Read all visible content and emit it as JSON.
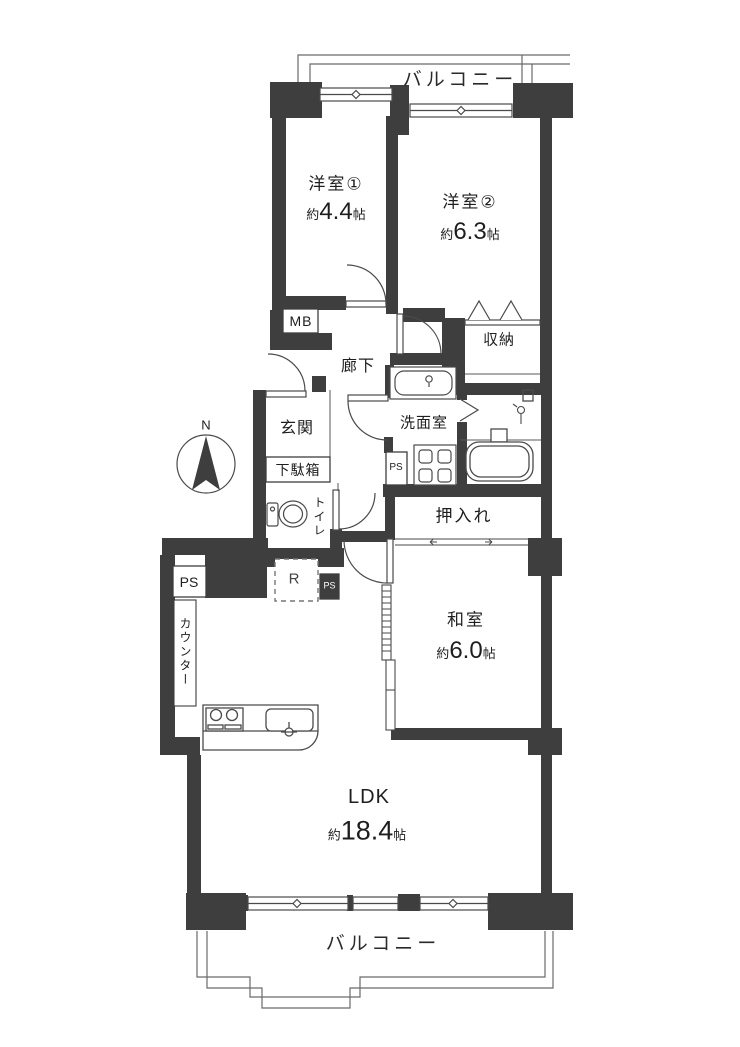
{
  "plan": {
    "compass": {
      "north_label": "N"
    },
    "balcony_top": {
      "label": "バルコニー"
    },
    "balcony_bottom": {
      "label": "バルコニー"
    },
    "rooms": {
      "yoshitsu1": {
        "name": "洋室①",
        "size_prefix": "約",
        "size_value": "4.4",
        "size_unit": "帖"
      },
      "yoshitsu2": {
        "name": "洋室②",
        "size_prefix": "約",
        "size_value": "6.3",
        "size_unit": "帖"
      },
      "washitsu": {
        "name": "和室",
        "size_prefix": "約",
        "size_value": "6.0",
        "size_unit": "帖"
      },
      "ldk": {
        "name": "LDK",
        "size_prefix": "約",
        "size_value": "18.4",
        "size_unit": "帖"
      }
    },
    "labels": {
      "genkan": "玄関",
      "getabako": "下駄箱",
      "rouka": "廊下",
      "shuno": "収納",
      "senmenshitsu": "洗面室",
      "oshiire": "押入れ",
      "toilet": "トイレ",
      "counter": "カウンター",
      "mb": "MB",
      "fridge": "R"
    },
    "ps": {
      "left": "PS",
      "mid": "PS",
      "wash": "PS"
    },
    "colors": {
      "wall": "#3e3e3e",
      "line": "#4a4a4a",
      "text": "#1e1e1e",
      "background": "#ffffff"
    }
  }
}
